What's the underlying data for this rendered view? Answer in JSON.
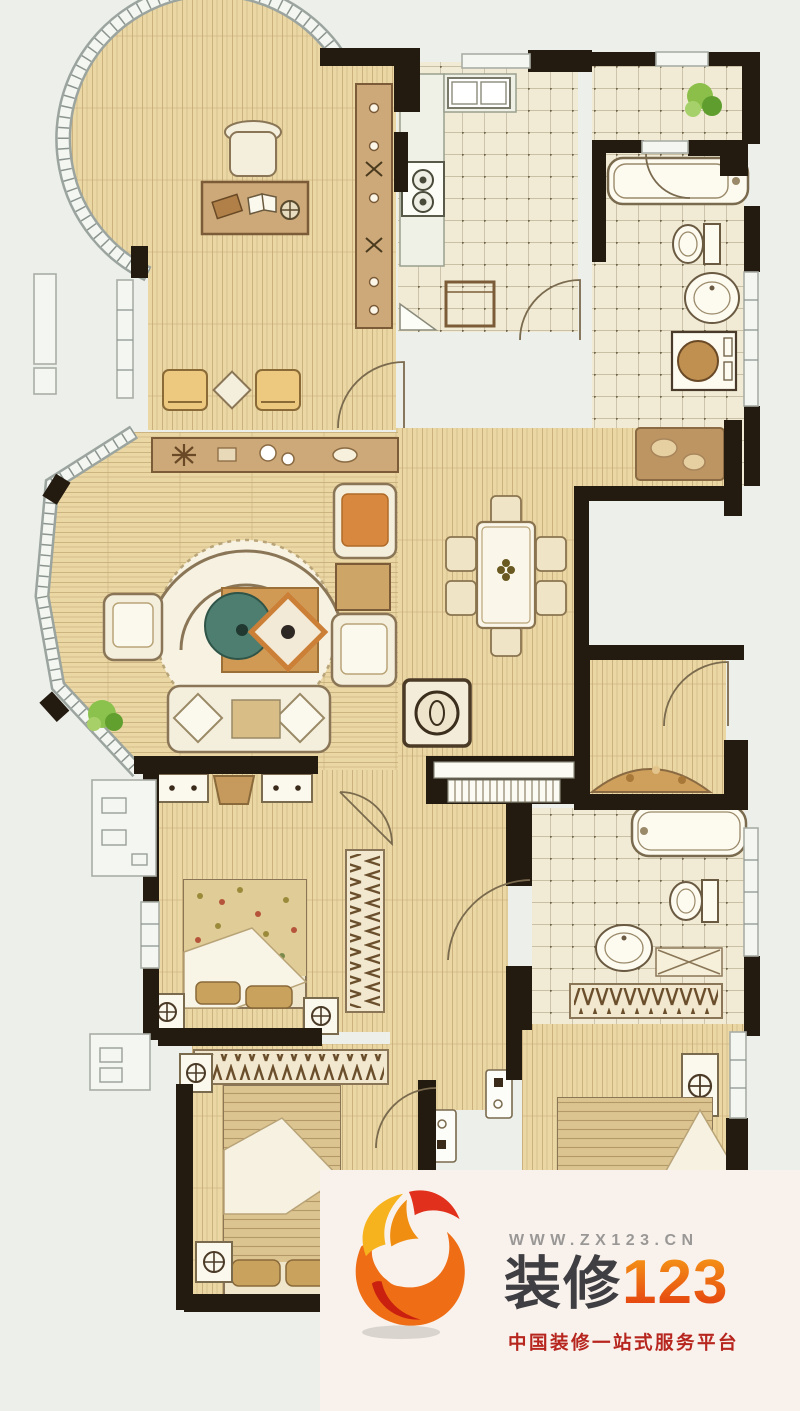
{
  "page": {
    "background": "#edefeb"
  },
  "floorplan": {
    "type": "apartment-floor-plan",
    "style": "hand-drawn watercolor rendering, no text labels visible",
    "colors": {
      "wall": "#231a10",
      "floor": "#ead7a4",
      "grain": "#c3a874",
      "tile": "#f1ebd5",
      "tile_line": "#8d8060",
      "furn_light": "#f4efdd",
      "furn_tan": "#cda97a",
      "furn_line": "#8a7656",
      "win_frame": "#9ba49e",
      "win_fill": "#f4f6f2",
      "teal": "#4d7e70",
      "orange": "#cc7f36",
      "plant": "#8bc24e"
    },
    "rooms": [
      "study-with-round-bay-window",
      "kitchen",
      "foyer",
      "bathroom",
      "stairwell-void",
      "dining-area",
      "living-room-with-bay-window",
      "corridor",
      "bedroom-middle-left",
      "bedroom-bottom-left",
      "master-bathroom",
      "master-bedroom"
    ],
    "furniture": [
      "desk-and-chair",
      "bookshelf",
      "armchair-pair",
      "kitchen-counter-sink-stove",
      "bathtub",
      "toilet",
      "pedestal-sink",
      "washing-machine",
      "entry-mat",
      "dining-table-with-six-chairs",
      "curved-sofa-set",
      "round-rug",
      "tv-cabinet",
      "console-table",
      "beds",
      "nightstands-with-lamps",
      "wardrobes-with-hangers",
      "potted-plants",
      "ac-platforms"
    ]
  },
  "watermark": {
    "url": "WWW.ZX123.CN",
    "brand_text": "装修",
    "brand_number": "123",
    "tagline": "中国装修一站式服务平台",
    "panel_background": "#f9f2ec",
    "url_color": "#9a9896",
    "brand_text_color": "#3f3e42",
    "brand_number_gradient": [
      "#f7a117",
      "#e2330f"
    ],
    "tagline_color": "#b7261e",
    "logo_colors": [
      "#f6b31d",
      "#e1301b",
      "#ee6d15",
      "#c9200f"
    ]
  }
}
